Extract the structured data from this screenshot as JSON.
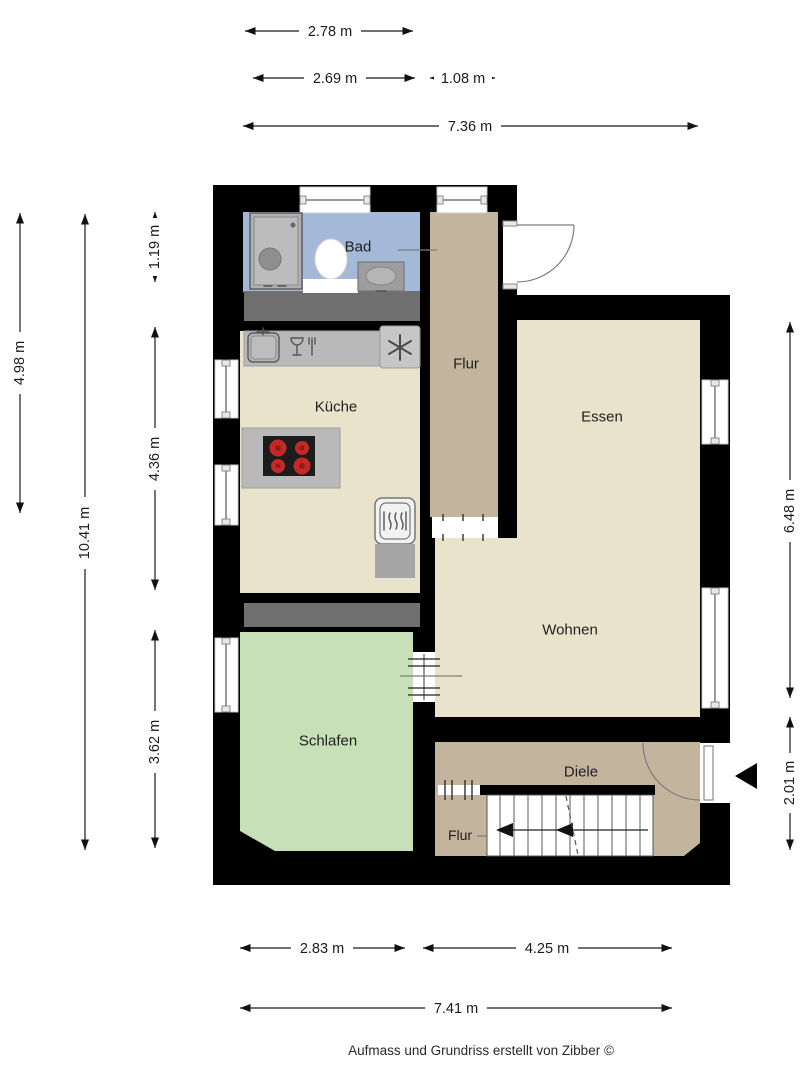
{
  "rooms": {
    "bad": "Bad",
    "flur_top": "Flur",
    "kueche": "Küche",
    "essen": "Essen",
    "wohnen": "Wohnen",
    "schlafen": "Schlafen",
    "diele": "Diele",
    "flur_bottom": "Flur"
  },
  "dims": {
    "top1": "2.78 m",
    "top2": "2.69 m",
    "top3": "1.08 m",
    "top4": "7.36 m",
    "left1": "4.98 m",
    "left2": "10.41 m",
    "left3": "1.19 m",
    "left4": "4.36 m",
    "left5": "3.62 m",
    "right1": "6.48 m",
    "right2": "2.01 m",
    "bottom1": "2.83 m",
    "bottom2": "4.25 m",
    "bottom3": "7.41 m"
  },
  "footer": {
    "credit": "Aufmass und Grundriss erstellt von Zibber ©"
  },
  "colors": {
    "wall": "#000000",
    "outside": "#ffffff",
    "floor_bad": "#a4b9d8",
    "floor_hall": "#c3b49d",
    "floor_living": "#eae3cb",
    "floor_sleep": "#c8e0b8",
    "duct": "#6f6f6f",
    "counter": "#b9b9b9",
    "appliance_light": "#c6c6c6",
    "cooktop": "#1c1c1c",
    "burner": "#c62828",
    "stairs": "#ffffff"
  }
}
